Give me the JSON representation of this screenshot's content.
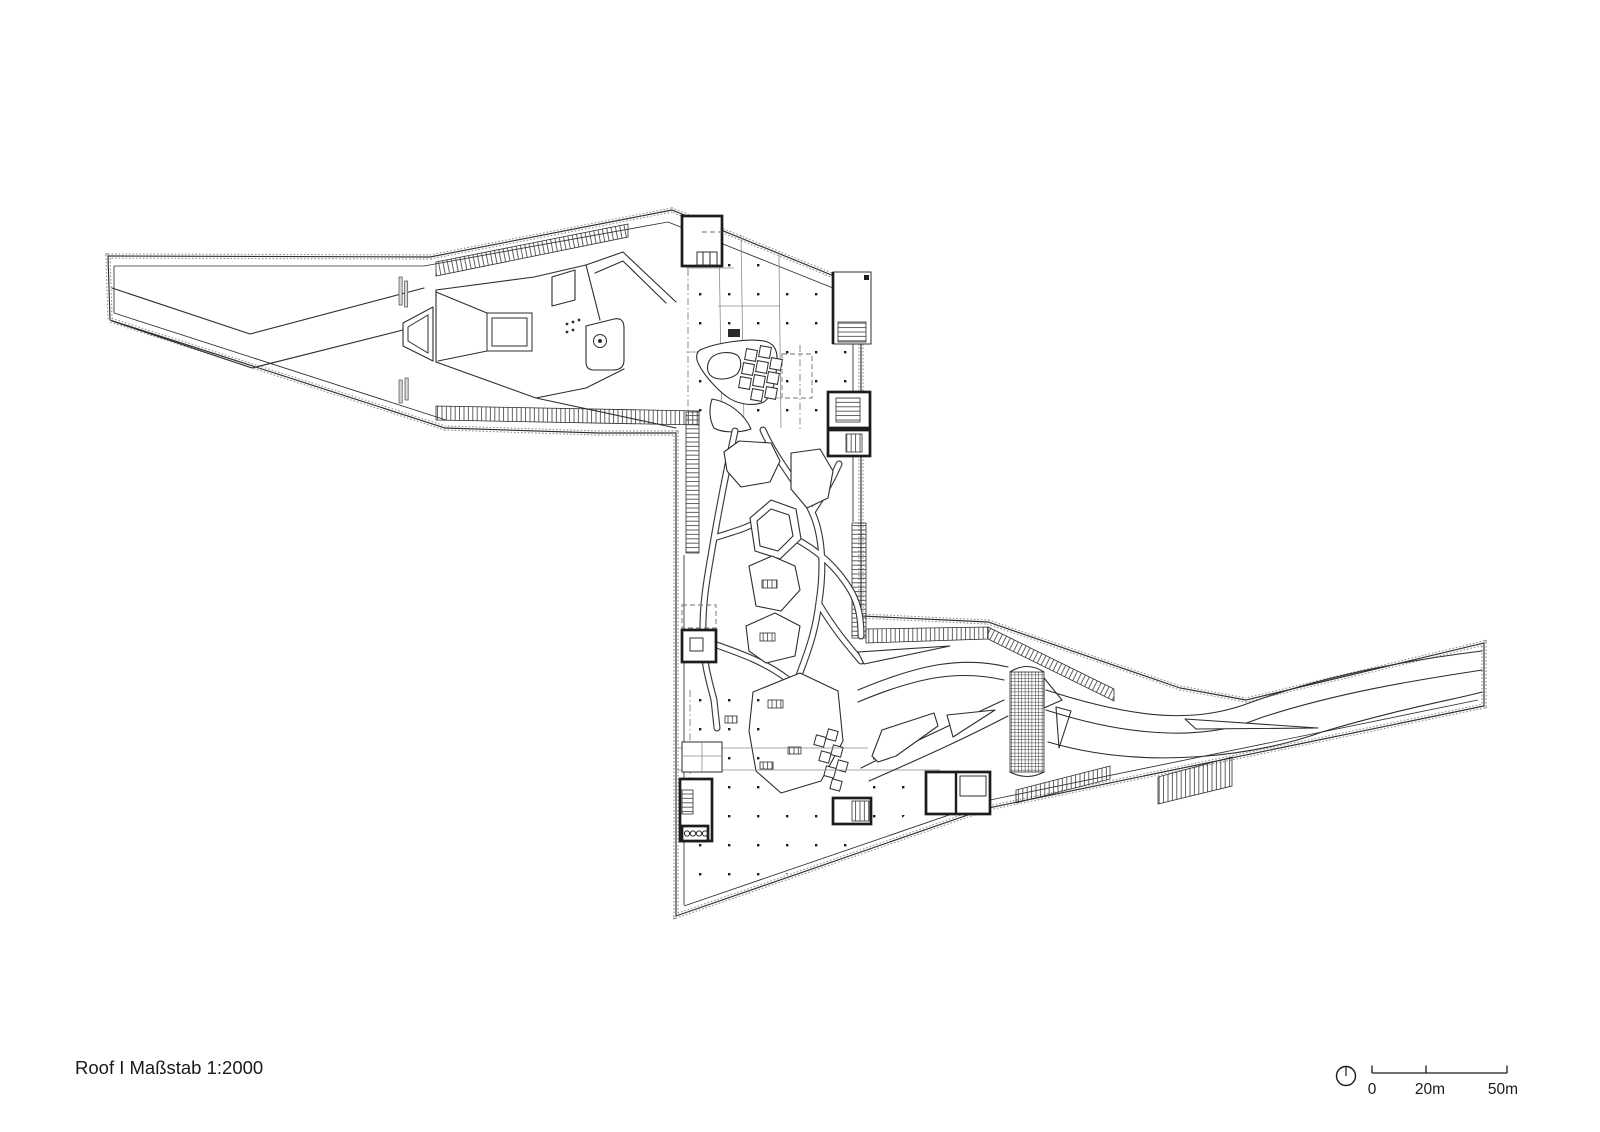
{
  "drawing": {
    "caption": "Roof I Maßstab 1:2000"
  },
  "scale_bar": {
    "labels": [
      "0",
      "20m",
      "50m"
    ]
  },
  "icons": {
    "north_indicator": "north-arrow-icon"
  },
  "colors": {
    "background": "#ffffff",
    "line": "#2d2d2d",
    "stipple_edge": "#8f8f8f",
    "light_line": "#8a8a8a"
  }
}
